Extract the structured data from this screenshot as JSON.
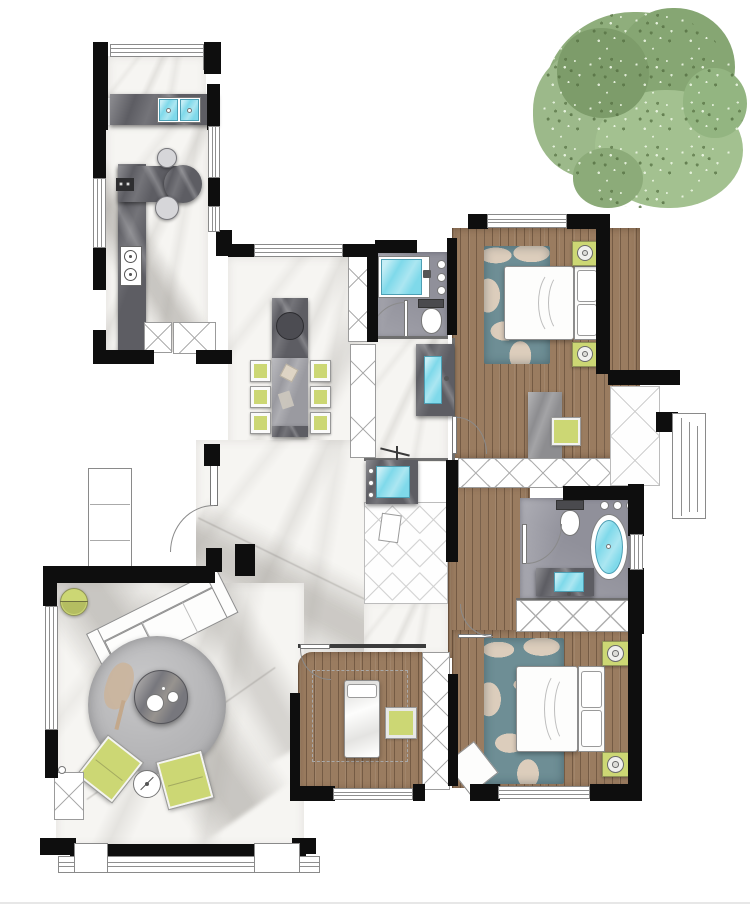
{
  "meta": {
    "title": "Apartment floor plan — rendered top view",
    "tree_label": "Tree canopy"
  },
  "colors": {
    "wall": "#0e0e0e",
    "marble": "#f6f5f2",
    "wood": "#9a7c60",
    "stone_dark": "#5d5d63",
    "stone_light": "#9a9aa0",
    "tile": "#90909a",
    "green": "#ccd774",
    "aqua": "#7fd9ea",
    "teal_rug": "#6e8e95",
    "beige": "#dccdbc",
    "rug_gray": "#b5b5b7",
    "tree": "#8fae7c",
    "line": "#8a8a8a"
  },
  "rooms": {
    "balcony": {
      "name": "Laundry balcony"
    },
    "kitchen": {
      "name": "Kitchen"
    },
    "dining": {
      "name": "Dining area"
    },
    "bathroom": {
      "name": "Bathroom"
    },
    "utility": {
      "name": "Utility / laundry room"
    },
    "hallway": {
      "name": "Hallway"
    },
    "bedroom1": {
      "name": "Bedroom (top right)"
    },
    "master_bathroom": {
      "name": "Master bathroom"
    },
    "bedroom2": {
      "name": "Bedroom (bottom middle)"
    },
    "bedroom3": {
      "name": "Master bedroom (bottom right)"
    },
    "living": {
      "name": "Living room"
    },
    "entry": {
      "name": "Entry"
    }
  },
  "furniture": {
    "double_sink": "Double laundry sink",
    "cooktop": "Two-burner cooktop",
    "fridge": "Refrigerator cabinet",
    "island": "Kitchen peninsula with stools",
    "dining_table": "Stone dining table with six chairs",
    "tall_cabinet": "Tall storage cabinet",
    "bathtub": "Built-in bathtub",
    "toilet": "Toilet",
    "basin": "Washbasin counter",
    "washer": "Washing machine / laundry sink",
    "oval_bathtub": "Freestanding oval bathtub",
    "vanity": "Bathroom vanity",
    "wardrobe": "Wardrobe",
    "bed_double": "Double bed with nightstands",
    "bed_single": "Single bed",
    "desk": "Stone desk with chair",
    "rug_camo": "Patterned area rug",
    "sofa": "Corner sofa",
    "rug_round": "Round rug",
    "coffee_table": "Round stone coffee table",
    "floor_lamp": "Floor lamp",
    "ottoman": "Ottoman",
    "side_table": "Round side table",
    "bench": "Bedroom bench",
    "nightstand": "Nightstand with lamp"
  }
}
